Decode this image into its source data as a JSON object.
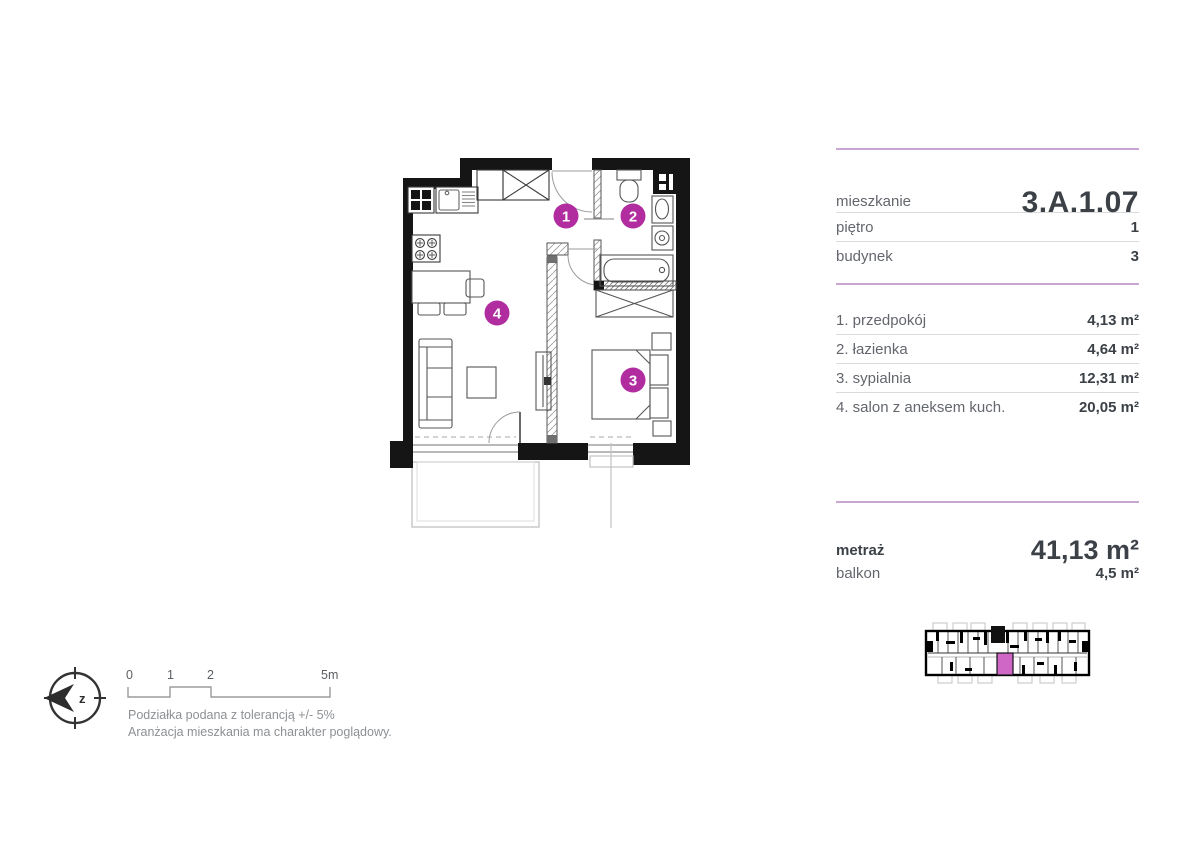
{
  "panel": {
    "unit": {
      "label": "mieszkanie",
      "value": "3.A.1.07"
    },
    "floor": {
      "label": "piętro",
      "value": "1"
    },
    "building": {
      "label": "budynek",
      "value": "3"
    },
    "rooms": [
      {
        "name": "1. przedpokój",
        "area": "4,13 m²"
      },
      {
        "name": "2. łazienka",
        "area": "4,64 m²"
      },
      {
        "name": "3. sypialnia",
        "area": "12,31 m²"
      },
      {
        "name": "4. salon z aneksem kuch.",
        "area": "20,05 m²"
      }
    ],
    "total": {
      "label": "metraż",
      "value": "41,13 m²"
    },
    "balcony": {
      "label": "balkon",
      "value": "4,5 m²"
    }
  },
  "plan": {
    "markers": [
      {
        "num": "1"
      },
      {
        "num": "2"
      },
      {
        "num": "3"
      },
      {
        "num": "4"
      }
    ],
    "marker_color": "#b02c9f"
  },
  "compass": {
    "label": "z"
  },
  "scale_bar": {
    "ticks": [
      "0",
      "1",
      "2",
      "5m"
    ]
  },
  "notes": {
    "line1": "Podziałka podana z tolerancją +/- 5%",
    "line2": "Aranżacja mieszkania ma charakter poglądowy."
  },
  "colors": {
    "accent": "#b02c9f",
    "divider_purple": "#c9a6d1",
    "minimap_highlight": "#cf67c7",
    "wall": "#151515"
  }
}
